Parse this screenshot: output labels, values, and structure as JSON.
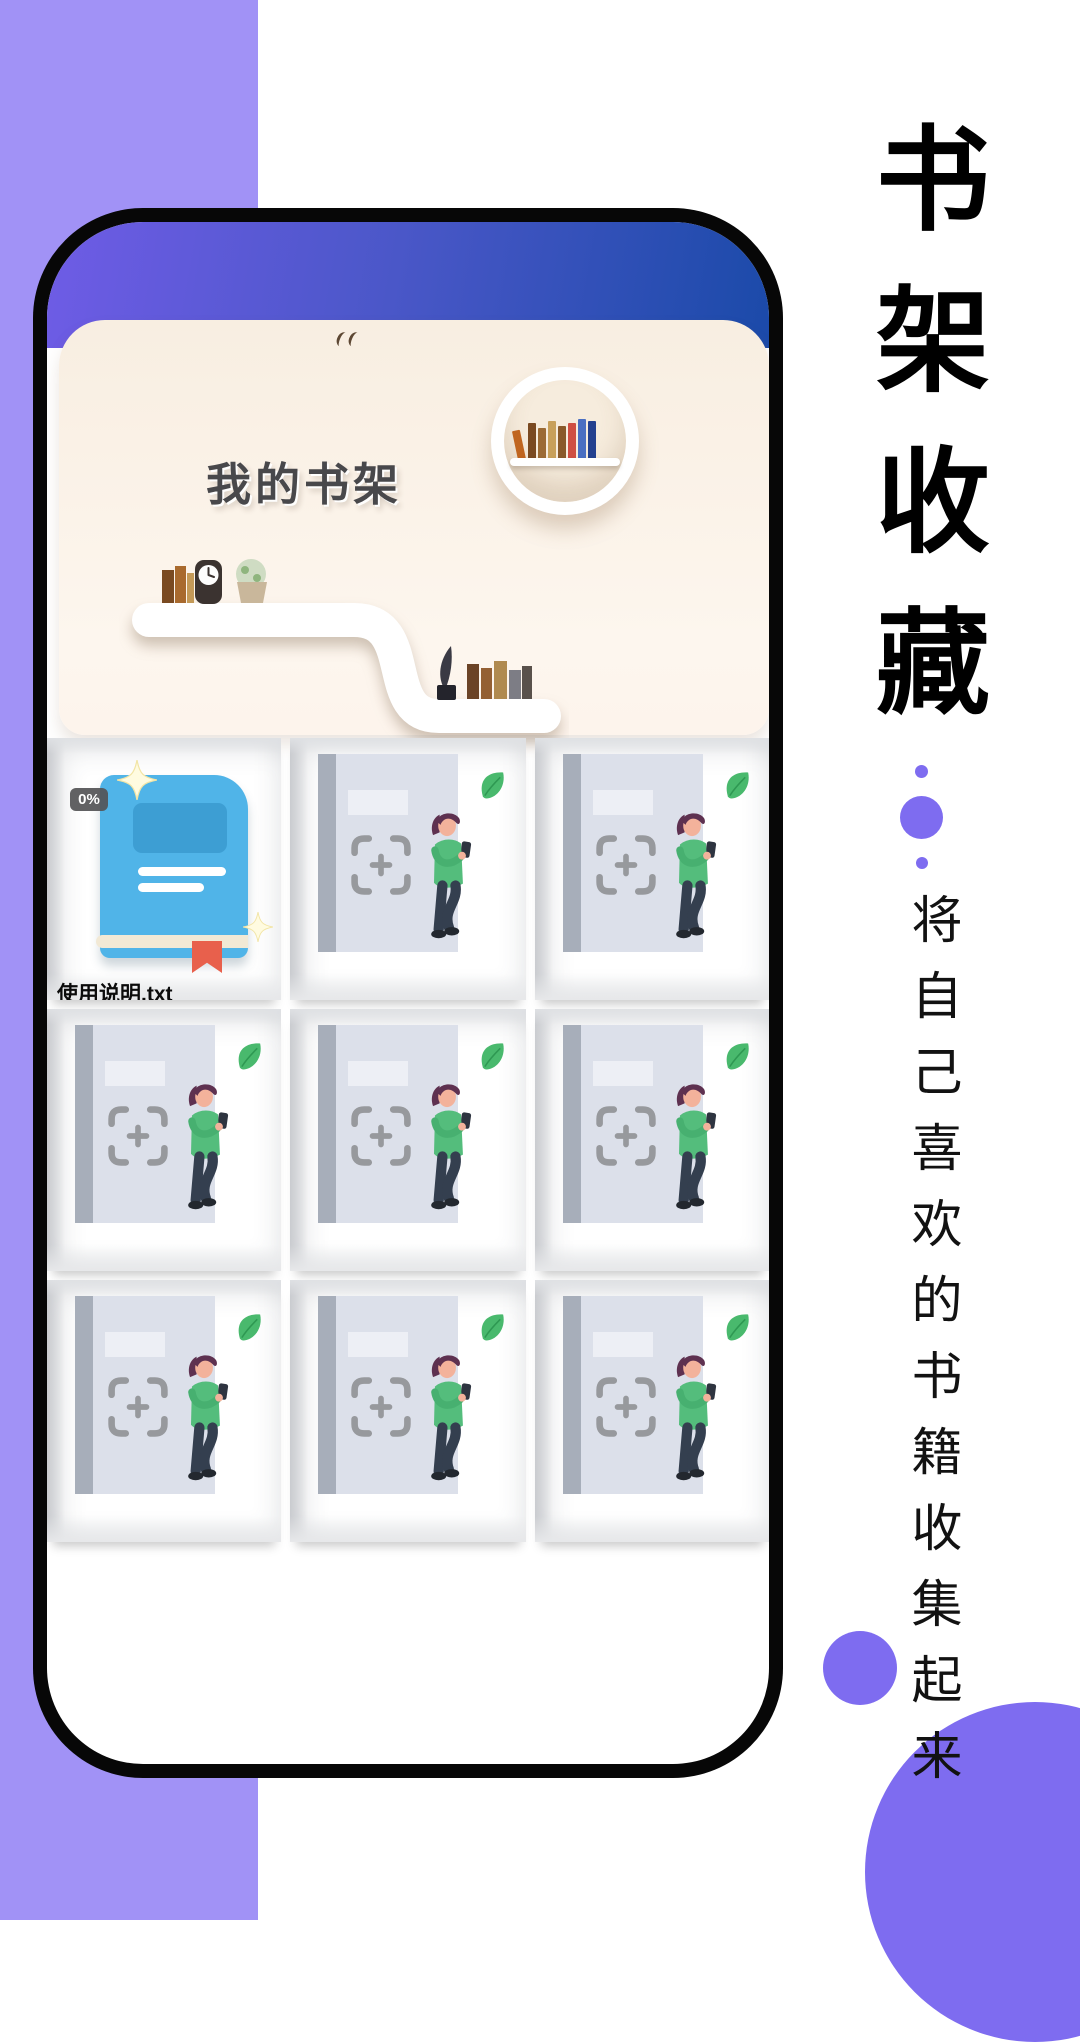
{
  "page": {
    "background": "#ffffff",
    "purple_block_color": "#a192f6",
    "accent_color": "#7e6cf0"
  },
  "right_panel": {
    "title_chars": [
      "书",
      "架",
      "收",
      "藏"
    ],
    "subtitle": "将自己喜欢的书籍收集起来"
  },
  "phone": {
    "header": {
      "gradient_left": "#6f5ce6",
      "gradient_right": "#1b4aa9"
    },
    "hero": {
      "title": "我的书架",
      "shelf_label": "书架",
      "panel_color": "#f8eee1"
    },
    "grid": {
      "file_cell": {
        "name": "使用说明.txt",
        "progress": "0%",
        "book_color": "#50b4e8"
      },
      "empty_cell_count": 8,
      "placeholder": {
        "shirt_color": "#54bd7c",
        "leaf_color": "#49b96d"
      }
    }
  }
}
